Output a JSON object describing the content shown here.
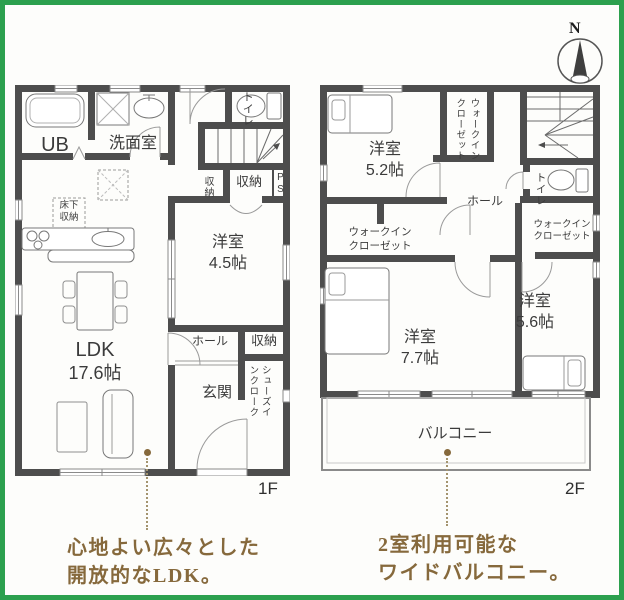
{
  "frame": {
    "border_color": "#2ca04e"
  },
  "compass": {
    "label": "N"
  },
  "floor1": {
    "floor_label": "1F",
    "labels": {
      "ub": "UB",
      "washroom": "洗面室",
      "toilet": "トイレ",
      "storage_stairs": "収納",
      "storage_band": "収納",
      "pipe_space": "PS",
      "underfloor_storage": "床下\n収納",
      "bedroom45_name": "洋室",
      "bedroom45_size": "4.5帖",
      "ldk_name": "LDK",
      "ldk_size": "17.6帖",
      "hall": "ホール",
      "storage_hall": "収納",
      "entrance": "玄関",
      "shoes_in_closet": "シューズインクローク"
    }
  },
  "floor2": {
    "floor_label": "2F",
    "labels": {
      "bedroom52_name": "洋室",
      "bedroom52_size": "5.2帖",
      "wic_top": "ウォークインクローゼット",
      "toilet": "トイレ",
      "hall": "ホール",
      "wic_left_line1": "ウォークイン",
      "wic_left_line2": "クローゼット",
      "wic_right_line1": "ウォークイン",
      "wic_right_line2": "クローゼット",
      "bedroom77_name": "洋室",
      "bedroom77_size": "7.7帖",
      "bedroom56_name": "洋室",
      "bedroom56_size": "5.6帖",
      "balcony": "バルコニー"
    }
  },
  "captions": {
    "accent_color": "#86693c",
    "ldk_line1": "心地よい広々とした",
    "ldk_line2": "開放的なLDK。",
    "balcony_line1": "2室利用可能な",
    "balcony_line2": "ワイドバルコニー。"
  }
}
